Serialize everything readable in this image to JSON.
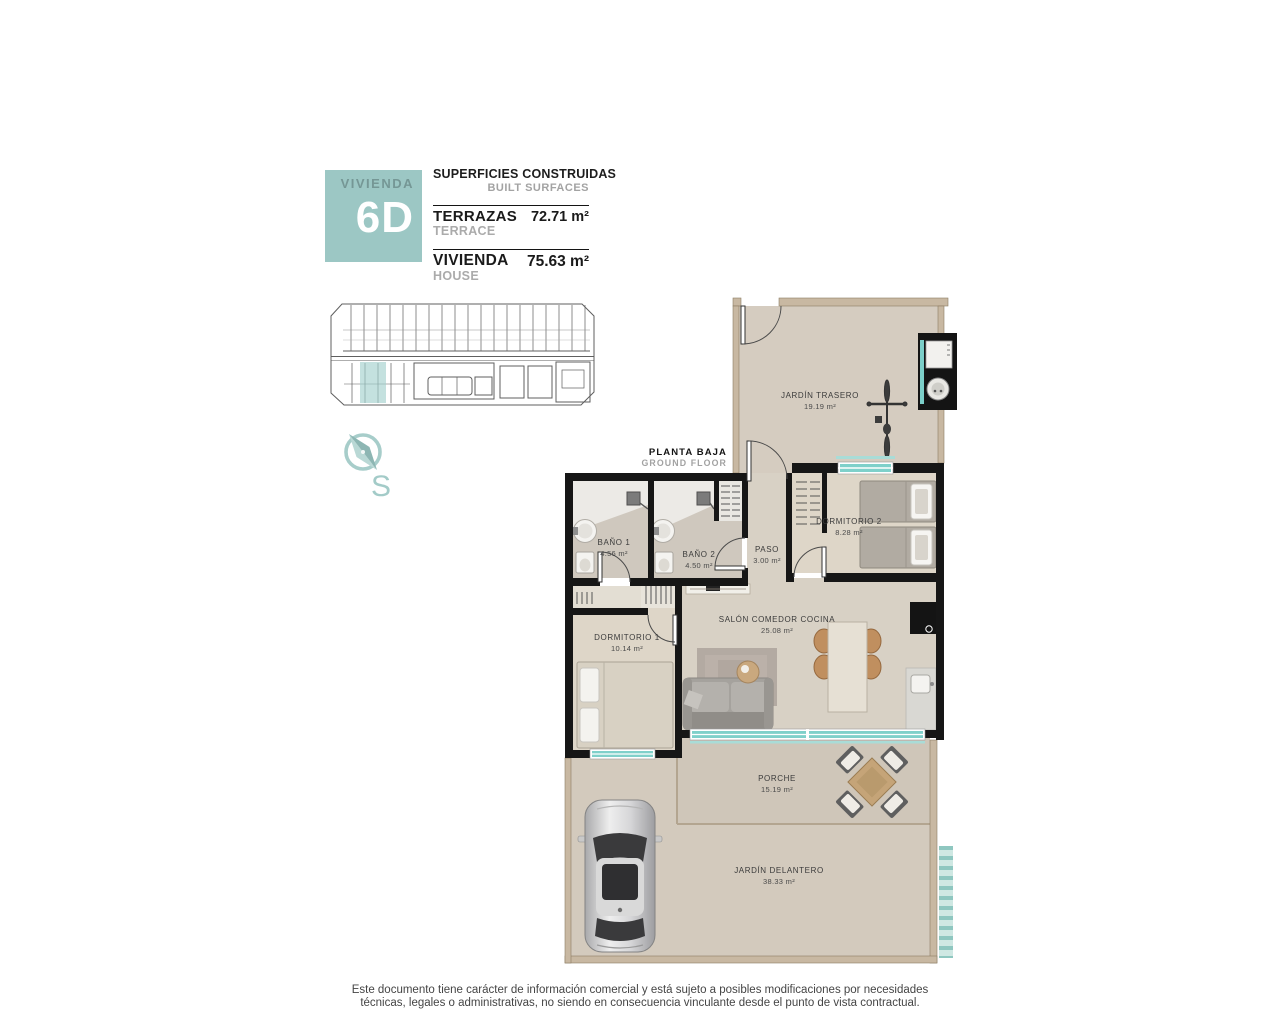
{
  "header": {
    "unit_label": "VIVIENDA",
    "unit_number": "6D",
    "surfaces_title": "SUPERFICIES CONSTRUIDAS",
    "surfaces_subtitle": "BUILT SURFACES",
    "rows": [
      {
        "label": "TERRAZAS",
        "label_en": "TERRACE",
        "value": "72.71 m²"
      },
      {
        "label": "VIVIENDA",
        "label_en": "HOUSE",
        "value": "75.63 m²"
      }
    ]
  },
  "plan": {
    "floor_label": "PLANTA BAJA",
    "floor_label_en": "GROUND FLOOR",
    "compass_letter": "S",
    "rooms": [
      {
        "name": "JARDÍN TRASERO",
        "area": "19.19 m²"
      },
      {
        "name": "BAÑO 1",
        "area": "4.56 m²"
      },
      {
        "name": "BAÑO 2",
        "area": "4.50 m²"
      },
      {
        "name": "PASO",
        "area": "3.00 m²"
      },
      {
        "name": "DORMITORIO 2",
        "area": "8.28 m²"
      },
      {
        "name": "DORMITORIO 1",
        "area": "10.14 m²"
      },
      {
        "name": "SALÓN COMEDOR COCINA",
        "area": "25.08 m²"
      },
      {
        "name": "PORCHE",
        "area": "15.19 m²"
      },
      {
        "name": "JARDÍN DELANTERO",
        "area": "38.33 m²"
      }
    ]
  },
  "footer": {
    "disclaimer_line1": "Este documento tiene carácter de información comercial y está sujeto a posibles modificaciones por necesidades",
    "disclaimer_line2": "técnicas, legales o administrativas, no siendo en consecuencia vinculante desde el punto de vista contractual."
  },
  "colors": {
    "accent_teal": "#9cc7c4",
    "wall_black": "#161616",
    "outer_wall_tan": "#c8b8a2",
    "floor_beige": "#d6cec2",
    "glass_teal": "#7fd0ca"
  }
}
